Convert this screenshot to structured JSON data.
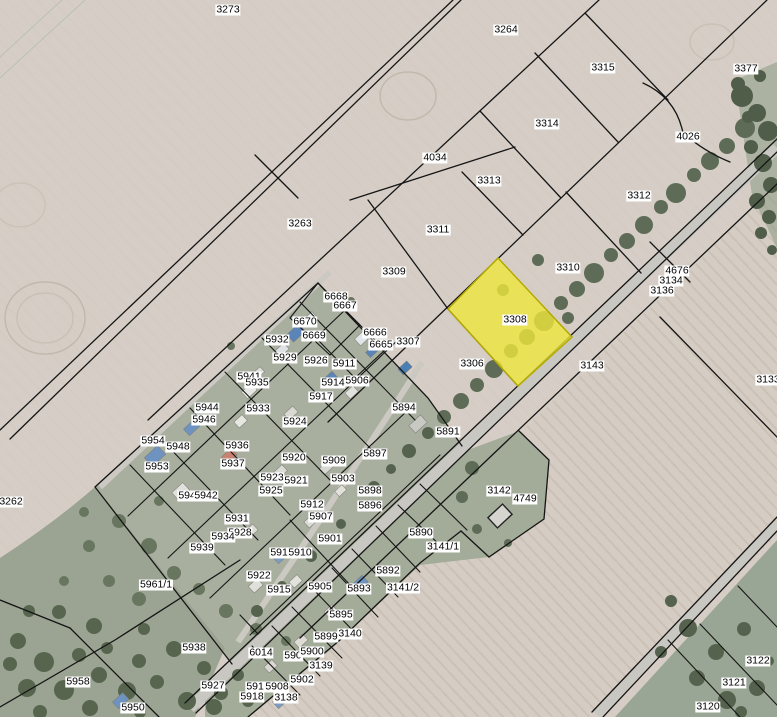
{
  "map": {
    "type": "cadastral-parcel-map-over-aerial-imagery",
    "highlighted_parcel": {
      "id": "3308",
      "fill": "#ede73c",
      "stroke": "#b3a900"
    },
    "colors": {
      "field": "#d6cec6",
      "field_plowed": "#cbc1b7",
      "village_green": "#a8af9f",
      "grass_green": "#9ba492",
      "road": "#c9c7c1",
      "tree": "#5e6c57",
      "boundary_line": "#151515",
      "label_bg": "#ffffff",
      "label_text": "#000000"
    },
    "parcels": [
      {
        "id": "3273",
        "x": 228,
        "y": 10
      },
      {
        "id": "3264",
        "x": 506,
        "y": 30
      },
      {
        "id": "3315",
        "x": 603,
        "y": 68
      },
      {
        "id": "3377",
        "x": 746,
        "y": 69
      },
      {
        "id": "3314",
        "x": 547,
        "y": 124
      },
      {
        "id": "4026",
        "x": 688,
        "y": 137
      },
      {
        "id": "4034",
        "x": 435,
        "y": 158
      },
      {
        "id": "3313",
        "x": 489,
        "y": 181
      },
      {
        "id": "3312",
        "x": 639,
        "y": 196
      },
      {
        "id": "3263",
        "x": 300,
        "y": 224
      },
      {
        "id": "3311",
        "x": 438,
        "y": 230
      },
      {
        "id": "3309",
        "x": 394,
        "y": 272
      },
      {
        "id": "3310",
        "x": 568,
        "y": 268
      },
      {
        "id": "4676",
        "x": 677,
        "y": 271
      },
      {
        "id": "3134",
        "x": 671,
        "y": 281
      },
      {
        "id": "3136",
        "x": 662,
        "y": 291
      },
      {
        "id": "6668",
        "x": 336,
        "y": 297
      },
      {
        "id": "6667",
        "x": 345,
        "y": 306
      },
      {
        "id": "6670",
        "x": 305,
        "y": 322
      },
      {
        "id": "6669",
        "x": 314,
        "y": 336
      },
      {
        "id": "5932",
        "x": 277,
        "y": 340
      },
      {
        "id": "6666",
        "x": 375,
        "y": 333
      },
      {
        "id": "6665",
        "x": 381,
        "y": 345
      },
      {
        "id": "3307",
        "x": 408,
        "y": 342
      },
      {
        "id": "5929",
        "x": 285,
        "y": 358
      },
      {
        "id": "5926",
        "x": 316,
        "y": 361
      },
      {
        "id": "5911",
        "x": 344,
        "y": 364
      },
      {
        "id": "3308",
        "x": 515,
        "y": 320
      },
      {
        "id": "5941",
        "x": 249,
        "y": 377
      },
      {
        "id": "5935",
        "x": 257,
        "y": 383
      },
      {
        "id": "5914",
        "x": 333,
        "y": 383
      },
      {
        "id": "5906",
        "x": 357,
        "y": 381
      },
      {
        "id": "3306",
        "x": 472,
        "y": 364
      },
      {
        "id": "3143",
        "x": 592,
        "y": 366
      },
      {
        "id": "3133",
        "x": 768,
        "y": 380
      },
      {
        "id": "5917",
        "x": 321,
        "y": 397
      },
      {
        "id": "5944",
        "x": 207,
        "y": 408
      },
      {
        "id": "5946",
        "x": 204,
        "y": 420
      },
      {
        "id": "5933",
        "x": 258,
        "y": 409
      },
      {
        "id": "5924",
        "x": 295,
        "y": 422
      },
      {
        "id": "5894",
        "x": 404,
        "y": 408
      },
      {
        "id": "5954",
        "x": 153,
        "y": 441
      },
      {
        "id": "5948",
        "x": 178,
        "y": 447
      },
      {
        "id": "5936",
        "x": 237,
        "y": 446
      },
      {
        "id": "5891",
        "x": 448,
        "y": 432
      },
      {
        "id": "5953",
        "x": 157,
        "y": 467
      },
      {
        "id": "5937",
        "x": 233,
        "y": 464
      },
      {
        "id": "5920",
        "x": 294,
        "y": 458
      },
      {
        "id": "5909",
        "x": 334,
        "y": 461
      },
      {
        "id": "5897",
        "x": 375,
        "y": 454
      },
      {
        "id": "5923",
        "x": 272,
        "y": 478
      },
      {
        "id": "5921",
        "x": 296,
        "y": 481
      },
      {
        "id": "5925",
        "x": 271,
        "y": 491
      },
      {
        "id": "5903",
        "x": 343,
        "y": 479
      },
      {
        "id": "5898",
        "x": 370,
        "y": 491
      },
      {
        "id": "5896",
        "x": 370,
        "y": 506
      },
      {
        "id": "3142",
        "x": 499,
        "y": 491
      },
      {
        "id": "4749",
        "x": 525,
        "y": 499
      },
      {
        "id": "5945",
        "x": 190,
        "y": 496
      },
      {
        "id": "5942",
        "x": 206,
        "y": 496
      },
      {
        "id": "5912",
        "x": 312,
        "y": 505
      },
      {
        "id": "5907",
        "x": 321,
        "y": 517
      },
      {
        "id": "5931",
        "x": 237,
        "y": 519
      },
      {
        "id": "5928",
        "x": 240,
        "y": 533
      },
      {
        "id": "5934",
        "x": 223,
        "y": 537
      },
      {
        "id": "5901",
        "x": 330,
        "y": 539
      },
      {
        "id": "5890",
        "x": 421,
        "y": 533
      },
      {
        "id": "3141/1",
        "x": 443,
        "y": 547
      },
      {
        "id": "5939",
        "x": 202,
        "y": 548
      },
      {
        "id": "5919",
        "x": 282,
        "y": 553
      },
      {
        "id": "5910",
        "x": 300,
        "y": 553
      },
      {
        "id": "5961/1",
        "x": 156,
        "y": 585
      },
      {
        "id": "5922",
        "x": 259,
        "y": 576
      },
      {
        "id": "5915",
        "x": 279,
        "y": 590
      },
      {
        "id": "5905",
        "x": 320,
        "y": 587
      },
      {
        "id": "5892",
        "x": 388,
        "y": 571
      },
      {
        "id": "5893",
        "x": 359,
        "y": 589
      },
      {
        "id": "3141/2",
        "x": 403,
        "y": 588
      },
      {
        "id": "5895",
        "x": 341,
        "y": 615
      },
      {
        "id": "5899",
        "x": 326,
        "y": 637
      },
      {
        "id": "3140",
        "x": 350,
        "y": 634
      },
      {
        "id": "5938",
        "x": 194,
        "y": 648
      },
      {
        "id": "6014",
        "x": 261,
        "y": 653
      },
      {
        "id": "590",
        "x": 293,
        "y": 656
      },
      {
        "id": "5900",
        "x": 312,
        "y": 652
      },
      {
        "id": "3139",
        "x": 321,
        "y": 666
      },
      {
        "id": "5902",
        "x": 302,
        "y": 680
      },
      {
        "id": "5927",
        "x": 213,
        "y": 686
      },
      {
        "id": "5916",
        "x": 258,
        "y": 687
      },
      {
        "id": "5908",
        "x": 277,
        "y": 687
      },
      {
        "id": "5918",
        "x": 252,
        "y": 697
      },
      {
        "id": "3138",
        "x": 286,
        "y": 698
      },
      {
        "id": "5958",
        "x": 78,
        "y": 682
      },
      {
        "id": "5950",
        "x": 133,
        "y": 708
      },
      {
        "id": "3262",
        "x": 11,
        "y": 502
      },
      {
        "id": "3122",
        "x": 758,
        "y": 661
      },
      {
        "id": "3121",
        "x": 734,
        "y": 683
      },
      {
        "id": "3120",
        "x": 708,
        "y": 707
      }
    ]
  }
}
